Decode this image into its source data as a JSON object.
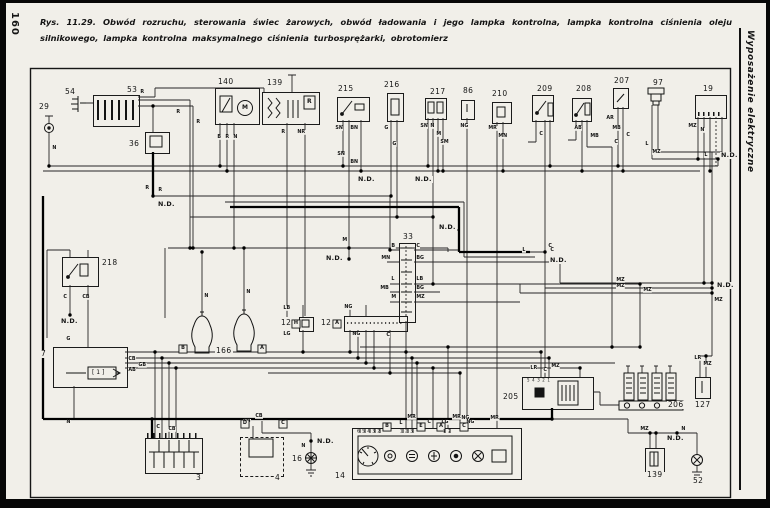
{
  "page": {
    "number": "160",
    "sidebar_title": "Wyposażenie elektryczne"
  },
  "caption": {
    "lead": "Rys. 11.29.",
    "body": "Obwód rozruchu, sterowania świec żarowych, obwód ładowania i jego lampka kontrolna, lampka kontrolna ciśnienia oleju silnikowego, lampka kontrolna maksymalnego ciśnienia turbosprężarki, obrotomierz"
  },
  "components": {
    "c29": "29",
    "c54": "54",
    "c53": "53",
    "c36": "36",
    "c140": "140",
    "c139": "139",
    "c215": "215",
    "c216": "216",
    "c217": "217",
    "c86": "86",
    "c210": "210",
    "c209": "209",
    "c208": "208",
    "c207": "207",
    "c97": "97",
    "c19": "19",
    "c218": "218",
    "c33": "33",
    "c12h": "12",
    "c12a": "12",
    "c166": "166",
    "c7": "7",
    "c3": "3",
    "c4": "4",
    "c16": "16",
    "c14": "14",
    "c205": "205",
    "c206": "206",
    "c127": "127",
    "c139b": "139",
    "c52": "52"
  },
  "inner": {
    "motor": "M",
    "regulator": "R",
    "ecu_block": "[ 1 ]"
  },
  "pin_rows": [
    {
      "t": "5 4 3 2 1",
      "x": 527,
      "y": 379
    },
    {
      "t": "6 5 4 3 2",
      "x": 357,
      "y": 430
    },
    {
      "t": "1 2 3",
      "x": 400,
      "y": 430
    },
    {
      "t": "1 2",
      "x": 443,
      "y": 430
    }
  ],
  "ground_labels": [
    {
      "t": "N.D.",
      "x": 157,
      "y": 201
    },
    {
      "t": "N.D.",
      "x": 357,
      "y": 176
    },
    {
      "t": "N.D.",
      "x": 414,
      "y": 176
    },
    {
      "t": "N.D.",
      "x": 60,
      "y": 318
    },
    {
      "t": "N.D.",
      "x": 325,
      "y": 255
    },
    {
      "t": "N.D.",
      "x": 438,
      "y": 224
    },
    {
      "t": "N.D.",
      "x": 549,
      "y": 257
    },
    {
      "t": "N.D.",
      "x": 316,
      "y": 438
    },
    {
      "t": "N.D.",
      "x": 666,
      "y": 435
    },
    {
      "t": "N.D.",
      "x": 716,
      "y": 282
    },
    {
      "t": "N.D.",
      "x": 720,
      "y": 152
    }
  ],
  "boxed_labels": [
    {
      "t": "B",
      "x": 178,
      "y": 344
    },
    {
      "t": "A",
      "x": 257,
      "y": 344
    },
    {
      "t": "H",
      "x": 291,
      "y": 319
    },
    {
      "t": "A",
      "x": 332,
      "y": 319
    },
    {
      "t": "D",
      "x": 240,
      "y": 419
    },
    {
      "t": "C",
      "x": 278,
      "y": 419
    },
    {
      "t": "B",
      "x": 382,
      "y": 422
    },
    {
      "t": "E",
      "x": 416,
      "y": 422
    },
    {
      "t": "A",
      "x": 436,
      "y": 422
    },
    {
      "t": "C",
      "x": 459,
      "y": 422
    }
  ],
  "wire_labels": [
    {
      "t": "N",
      "x": 52,
      "y": 146
    },
    {
      "t": "R",
      "x": 140,
      "y": 90
    },
    {
      "t": "R",
      "x": 176,
      "y": 110
    },
    {
      "t": "R",
      "x": 196,
      "y": 120
    },
    {
      "t": "R",
      "x": 145,
      "y": 186
    },
    {
      "t": "R",
      "x": 158,
      "y": 188
    },
    {
      "t": "B",
      "x": 217,
      "y": 135
    },
    {
      "t": "R",
      "x": 225,
      "y": 135
    },
    {
      "t": "N",
      "x": 233,
      "y": 135
    },
    {
      "t": "R",
      "x": 281,
      "y": 130
    },
    {
      "t": "NR",
      "x": 297,
      "y": 130
    },
    {
      "t": "SN",
      "x": 335,
      "y": 126
    },
    {
      "t": "BN",
      "x": 350,
      "y": 126
    },
    {
      "t": "SN",
      "x": 337,
      "y": 152
    },
    {
      "t": "BN",
      "x": 350,
      "y": 160
    },
    {
      "t": "G",
      "x": 384,
      "y": 126
    },
    {
      "t": "G",
      "x": 392,
      "y": 142
    },
    {
      "t": "SN",
      "x": 420,
      "y": 124
    },
    {
      "t": "N",
      "x": 430,
      "y": 124
    },
    {
      "t": "M",
      "x": 436,
      "y": 132
    },
    {
      "t": "SM",
      "x": 440,
      "y": 140
    },
    {
      "t": "NG",
      "x": 460,
      "y": 124
    },
    {
      "t": "NG",
      "x": 461,
      "y": 416
    },
    {
      "t": "MR",
      "x": 488,
      "y": 126
    },
    {
      "t": "MN",
      "x": 498,
      "y": 134
    },
    {
      "t": "MR",
      "x": 490,
      "y": 416
    },
    {
      "t": "C",
      "x": 539,
      "y": 132
    },
    {
      "t": "C",
      "x": 548,
      "y": 244
    },
    {
      "t": "AB",
      "x": 574,
      "y": 126
    },
    {
      "t": "MB",
      "x": 590,
      "y": 134
    },
    {
      "t": "C",
      "x": 614,
      "y": 140
    },
    {
      "t": "AR",
      "x": 606,
      "y": 116
    },
    {
      "t": "MB",
      "x": 612,
      "y": 126
    },
    {
      "t": "C",
      "x": 626,
      "y": 133
    },
    {
      "t": "L",
      "x": 645,
      "y": 142
    },
    {
      "t": "MZ",
      "x": 652,
      "y": 150
    },
    {
      "t": "MZ",
      "x": 688,
      "y": 124
    },
    {
      "t": "N",
      "x": 700,
      "y": 128
    },
    {
      "t": "L",
      "x": 704,
      "y": 153
    },
    {
      "t": "MZ",
      "x": 616,
      "y": 278
    },
    {
      "t": "MZ",
      "x": 616,
      "y": 284
    },
    {
      "t": "MZ",
      "x": 643,
      "y": 288
    },
    {
      "t": "MZ",
      "x": 714,
      "y": 298
    },
    {
      "t": "LR",
      "x": 694,
      "y": 356
    },
    {
      "t": "MZ",
      "x": 703,
      "y": 362
    },
    {
      "t": "B",
      "x": 391,
      "y": 244
    },
    {
      "t": "C",
      "x": 416,
      "y": 244
    },
    {
      "t": "MN",
      "x": 381,
      "y": 256
    },
    {
      "t": "BG",
      "x": 416,
      "y": 256
    },
    {
      "t": "L",
      "x": 391,
      "y": 277
    },
    {
      "t": "LB",
      "x": 416,
      "y": 277
    },
    {
      "t": "MB",
      "x": 380,
      "y": 286
    },
    {
      "t": "BG",
      "x": 416,
      "y": 286
    },
    {
      "t": "M",
      "x": 391,
      "y": 295
    },
    {
      "t": "MZ",
      "x": 416,
      "y": 295
    },
    {
      "t": "M",
      "x": 342,
      "y": 238
    },
    {
      "t": "LB",
      "x": 283,
      "y": 306
    },
    {
      "t": "LG",
      "x": 283,
      "y": 332
    },
    {
      "t": "NG",
      "x": 344,
      "y": 305
    },
    {
      "t": "NG",
      "x": 352,
      "y": 332
    },
    {
      "t": "C",
      "x": 386,
      "y": 333
    },
    {
      "t": "N",
      "x": 204,
      "y": 294
    },
    {
      "t": "N",
      "x": 246,
      "y": 290
    },
    {
      "t": "C",
      "x": 63,
      "y": 295
    },
    {
      "t": "CB",
      "x": 82,
      "y": 295
    },
    {
      "t": "G",
      "x": 66,
      "y": 337
    },
    {
      "t": "CB",
      "x": 128,
      "y": 357
    },
    {
      "t": "GB",
      "x": 138,
      "y": 363
    },
    {
      "t": "AB",
      "x": 128,
      "y": 368
    },
    {
      "t": "N",
      "x": 66,
      "y": 420
    },
    {
      "t": "C",
      "x": 156,
      "y": 425
    },
    {
      "t": "CB",
      "x": 168,
      "y": 427
    },
    {
      "t": "LR",
      "x": 530,
      "y": 366
    },
    {
      "t": "C",
      "x": 543,
      "y": 368
    },
    {
      "t": "MZ",
      "x": 551,
      "y": 364
    },
    {
      "t": "L",
      "x": 522,
      "y": 248
    },
    {
      "t": "C",
      "x": 550,
      "y": 248
    },
    {
      "t": "CB",
      "x": 243,
      "y": 419
    },
    {
      "t": "CB",
      "x": 255,
      "y": 414
    },
    {
      "t": "N",
      "x": 301,
      "y": 444
    },
    {
      "t": "L",
      "x": 399,
      "y": 421
    },
    {
      "t": "MR",
      "x": 407,
      "y": 415
    },
    {
      "t": "C",
      "x": 427,
      "y": 420
    },
    {
      "t": "LG",
      "x": 441,
      "y": 420
    },
    {
      "t": "MR",
      "x": 452,
      "y": 415
    },
    {
      "t": "NG",
      "x": 466,
      "y": 420
    },
    {
      "t": "MZ",
      "x": 640,
      "y": 427
    },
    {
      "t": "N",
      "x": 681,
      "y": 427
    }
  ]
}
